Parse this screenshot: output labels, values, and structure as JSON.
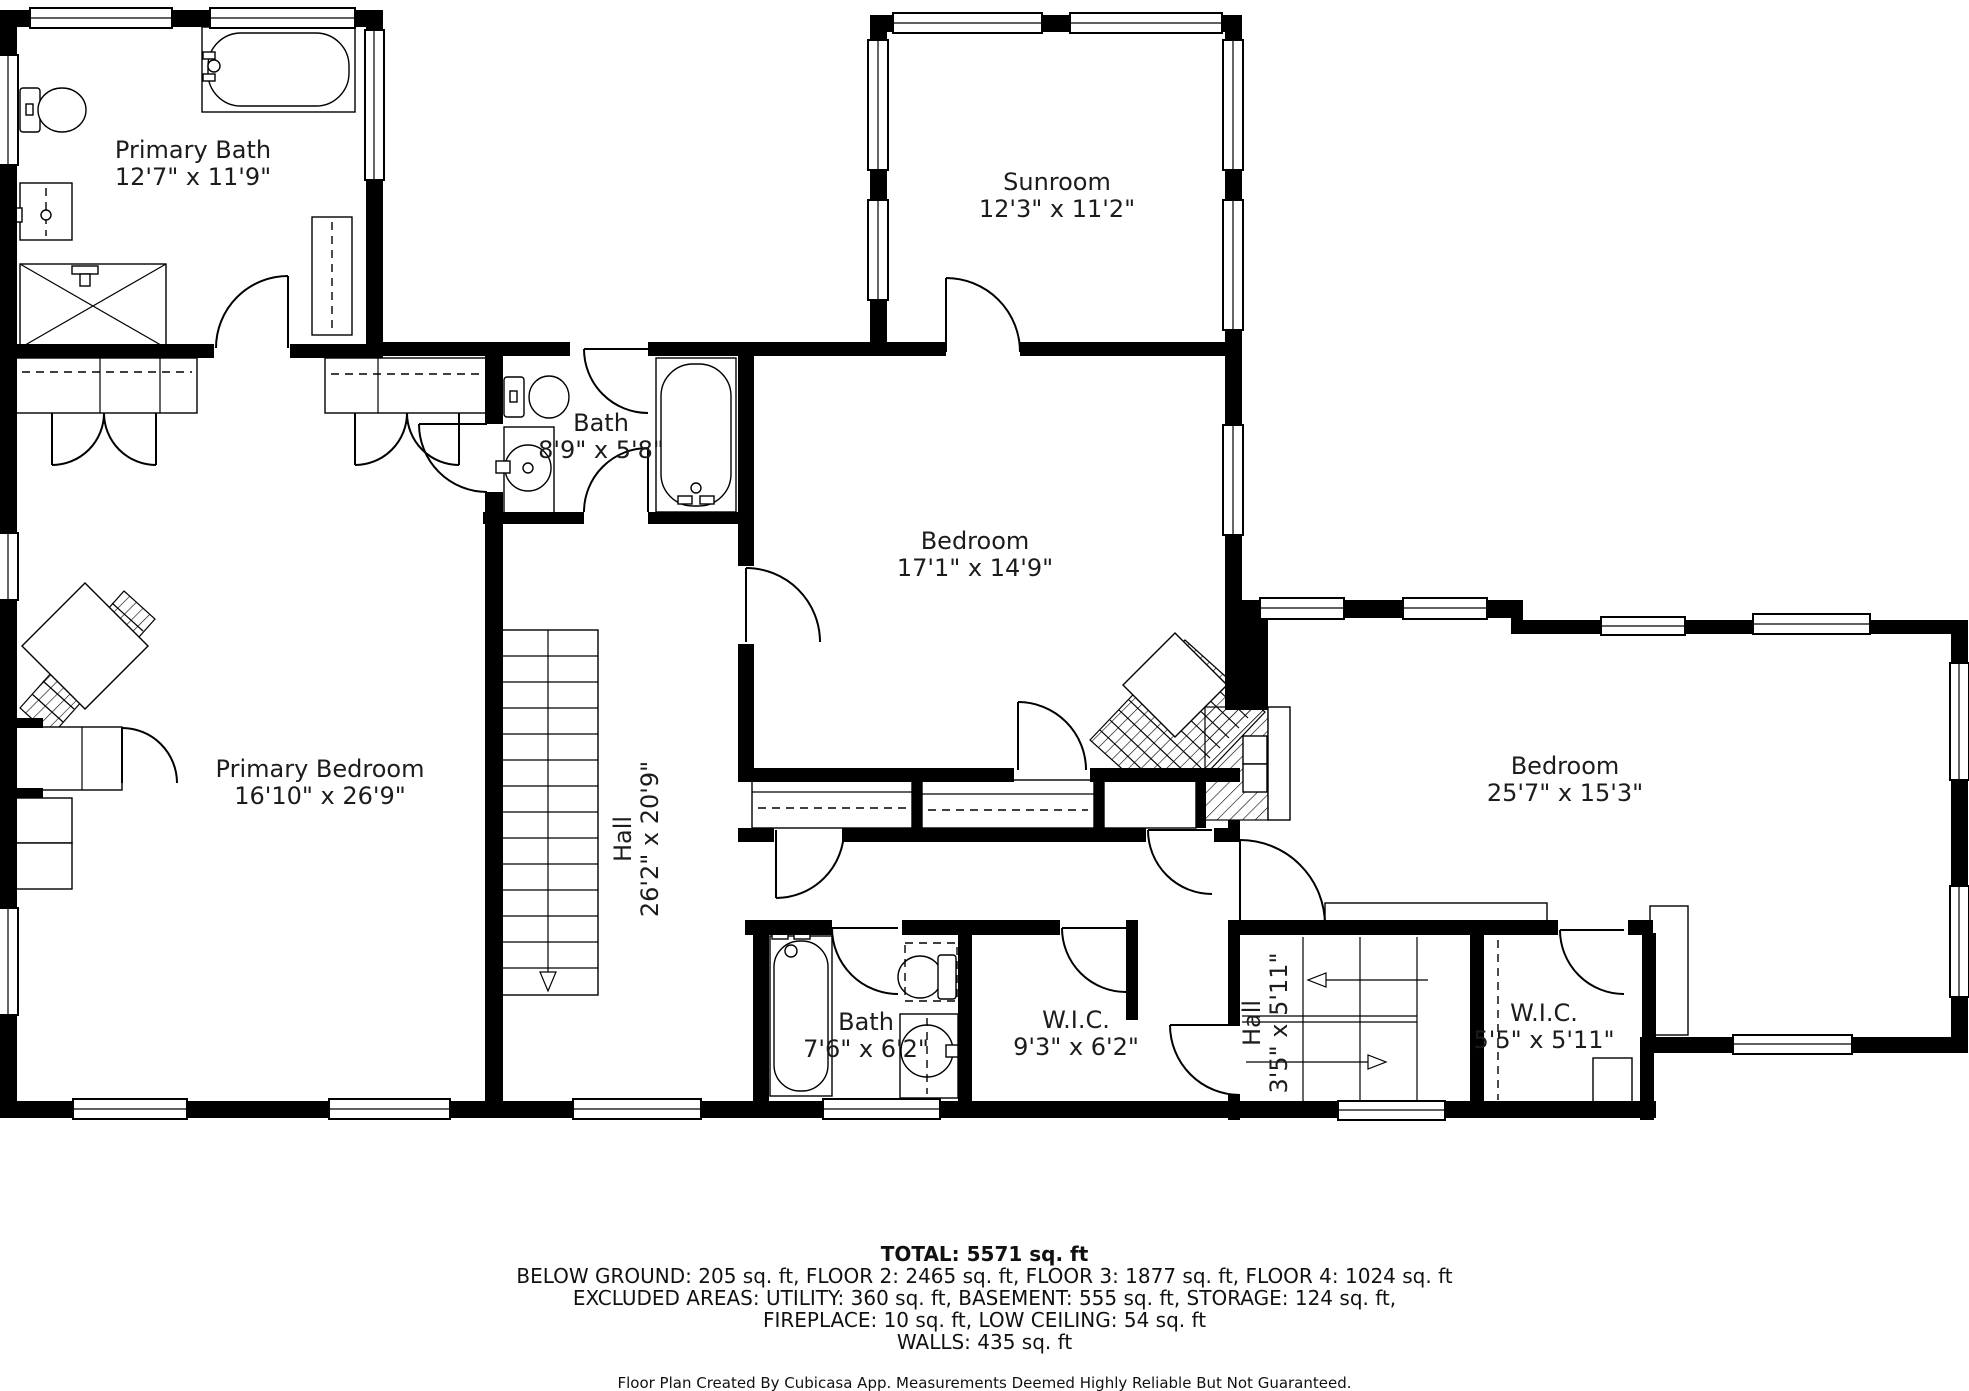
{
  "plan": {
    "app": "Cubicasa",
    "wall_color": "#000000",
    "background": "#ffffff"
  },
  "rooms": [
    {
      "id": "primary-bath",
      "name": "Primary Bath",
      "dims": "12'7\" x 11'9\"",
      "x": 193,
      "y": 150,
      "rotate": 0
    },
    {
      "id": "sunroom",
      "name": "Sunroom",
      "dims": "12'3\" x 11'2\"",
      "x": 1057,
      "y": 182,
      "rotate": 0
    },
    {
      "id": "bath-middle",
      "name": "Bath",
      "dims": "8'9\" x 5'8\"",
      "x": 601,
      "y": 423,
      "rotate": 0
    },
    {
      "id": "bedroom-middle",
      "name": "Bedroom",
      "dims": "17'1\" x 14'9\"",
      "x": 975,
      "y": 541,
      "rotate": 0
    },
    {
      "id": "primary-bedroom",
      "name": "Primary Bedroom",
      "dims": "16'10\" x 26'9\"",
      "x": 320,
      "y": 769,
      "rotate": 0
    },
    {
      "id": "hall-main",
      "name": "Hall",
      "dims": "26'2\" x 20'9\"",
      "x": 623,
      "y": 839,
      "rotate": -90
    },
    {
      "id": "bedroom-right",
      "name": "Bedroom",
      "dims": "25'7\" x 15'3\"",
      "x": 1565,
      "y": 766,
      "rotate": 0
    },
    {
      "id": "bath-lower",
      "name": "Bath",
      "dims": "7'6\" x 6'2\"",
      "x": 866,
      "y": 1022,
      "rotate": 0
    },
    {
      "id": "wic-large",
      "name": "W.I.C.",
      "dims": "9'3\" x 6'2\"",
      "x": 1076,
      "y": 1020,
      "rotate": 0
    },
    {
      "id": "hall-lower",
      "name": "Hall",
      "dims": "3'5\" x 5'11\"",
      "x": 1252,
      "y": 1023,
      "rotate": -90
    },
    {
      "id": "wic-small",
      "name": "W.I.C.",
      "dims": "5'5\" x 5'11\"",
      "x": 1544,
      "y": 1013,
      "rotate": 0
    }
  ],
  "footer": {
    "total": "TOTAL: 5571 sq. ft",
    "lines": [
      "BELOW GROUND: 205 sq. ft, FLOOR 2: 2465 sq. ft, FLOOR 3: 1877 sq. ft, FLOOR 4: 1024 sq. ft",
      "EXCLUDED AREAS: UTILITY: 360 sq. ft, BASEMENT: 555 sq. ft, STORAGE: 124 sq. ft,",
      "FIREPLACE: 10 sq. ft, LOW CEILING: 54 sq. ft",
      "WALLS: 435 sq. ft"
    ],
    "credit": "Floor Plan Created By Cubicasa App. Measurements Deemed Highly Reliable But Not Guaranteed."
  }
}
